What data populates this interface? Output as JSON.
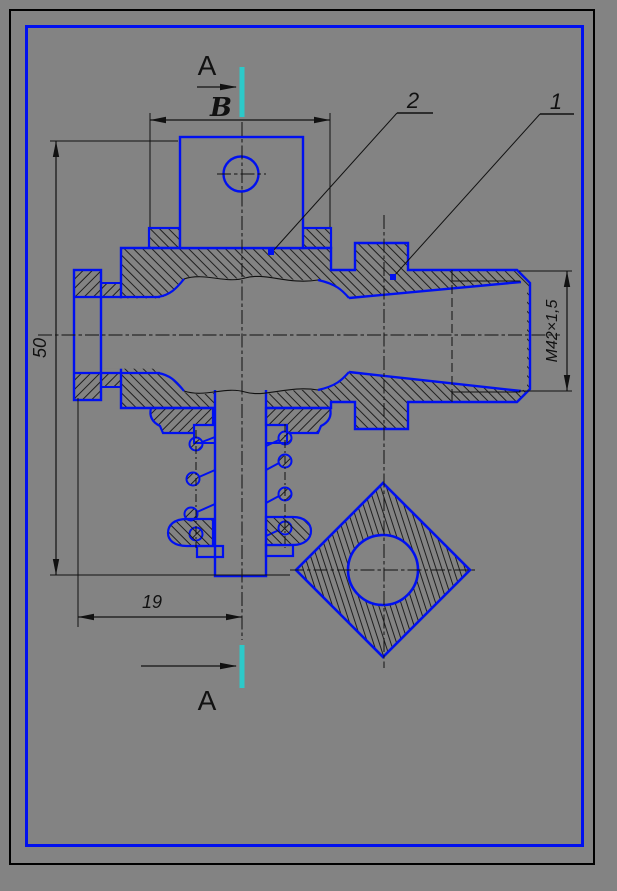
{
  "drawing": {
    "section_marker_top": {
      "letter": "A"
    },
    "section_marker_bottom": {
      "letter": "A"
    },
    "width_var_label": "В",
    "callouts": {
      "item1": "1",
      "item2": "2"
    },
    "dimensions": {
      "height": "50",
      "offset": "19",
      "thread": "M42×1,5"
    }
  },
  "colors": {
    "background": "#838383",
    "line_blue": "#0010f0",
    "line_black": "#111111",
    "section_cyan": "#2dc9c9",
    "frame_black": "#000000"
  }
}
